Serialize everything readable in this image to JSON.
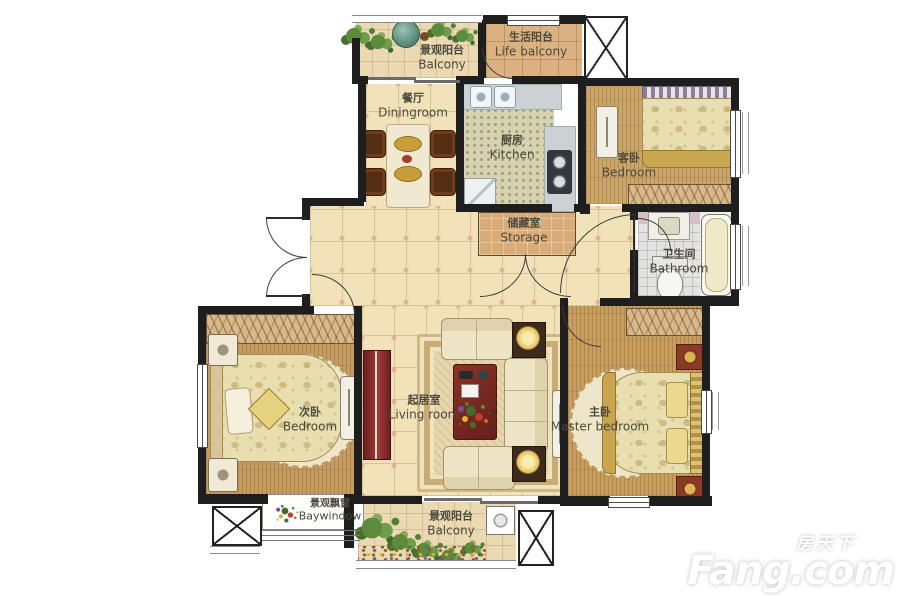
{
  "watermark": {
    "cn": "房天下",
    "en": "Fang.com"
  },
  "rooms": [
    {
      "id": "balcony-top",
      "cn": "景观阳台",
      "en": "Balcony"
    },
    {
      "id": "life-balcony",
      "cn": "生活阳台",
      "en": "Life balcony"
    },
    {
      "id": "dining-room",
      "cn": "餐厅",
      "en": "Diningroom"
    },
    {
      "id": "kitchen",
      "cn": "厨房",
      "en": "Kitchen"
    },
    {
      "id": "guest-bedroom",
      "cn": "客卧",
      "en": "Bedroom"
    },
    {
      "id": "storage",
      "cn": "储藏室",
      "en": "Storage"
    },
    {
      "id": "bathroom",
      "cn": "卫生间",
      "en": "Bathroom"
    },
    {
      "id": "second-bedroom",
      "cn": "次卧",
      "en": "Bedroom"
    },
    {
      "id": "living-room",
      "cn": "起居室",
      "en": "Living room"
    },
    {
      "id": "master-bedroom",
      "cn": "主卧",
      "en": "Master bedroom"
    },
    {
      "id": "bay-window",
      "cn": "景观飘窗",
      "en": "Baywindow"
    },
    {
      "id": "balcony-bottom",
      "cn": "景观阳台",
      "en": "Balcony"
    }
  ],
  "colors": {
    "wall": "#1e1e1e",
    "hall_tile": "#f1e2b9",
    "wood_floor": "#c59c62",
    "accent_red": "#8a3228",
    "plant_green": "#5d8a3c",
    "label_text": "#4b4a3c"
  }
}
